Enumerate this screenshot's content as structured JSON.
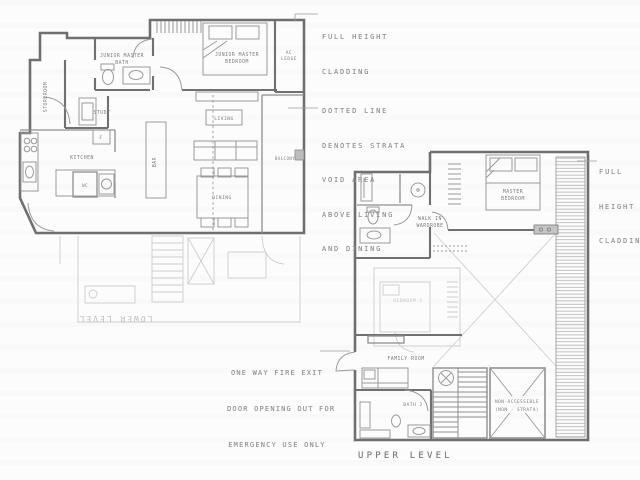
{
  "document": {
    "type": "architectural floor plan, scanned",
    "levels": [
      "LOWER LEVEL",
      "UPPER LEVEL"
    ]
  },
  "annotations": {
    "cladding_top": {
      "lines": [
        "FULL HEIGHT",
        "CLADDING"
      ]
    },
    "strata_note": {
      "lines": [
        "DOTTED LINE",
        "DENOTES STRATA",
        "VOID AREA",
        "ABOVE LIVING",
        "AND DINING"
      ]
    },
    "cladding_right": {
      "lines": [
        "FULL",
        "HEIGHT",
        "CLADDING"
      ]
    },
    "fire_exit_note": {
      "lines": [
        "ONE WAY FIRE EXIT",
        "DOOR OPENING OUT FOR",
        "EMERGENCY USE ONLY"
      ]
    },
    "upper_level_label": "UPPER LEVEL",
    "lower_level_ghost_label": "LOWER LEVEL"
  },
  "lower_plan": {
    "rooms": {
      "storeroom": "STOREROOM",
      "junior_master_bath": [
        "JUNIOR MASTER",
        "BATH"
      ],
      "junior_master_bedroom": [
        "JUNIOR MASTER",
        "BEDROOM"
      ],
      "ac_ledge": [
        "AC",
        "LEDGE"
      ],
      "study": "STUDY",
      "fridge": "F",
      "kitchen": "KITCHEN",
      "wc": "WC",
      "bar": "BAR",
      "living": "LIVING",
      "dining": "DINING",
      "balcony": "BALCONY"
    }
  },
  "upper_plan": {
    "rooms": {
      "walk_in_wardrobe": [
        "WALK IN",
        "WARDROBE"
      ],
      "master_bedroom": [
        "MASTER",
        "BEDROOM"
      ],
      "family_room": "FAMILY ROOM",
      "bath_2": "BATH 2",
      "non_accessible": [
        "NON-ACCESSIBLE",
        "(NON - STRATA)"
      ],
      "ghost_bedroom": "BEDROOM 2"
    }
  },
  "colors": {
    "paper": "#fcfcfc",
    "wall": "#6f6f6f",
    "thin_line": "#9a9a9a",
    "ghost_line": "#c9c9c9",
    "hatch": "#a8a8a8",
    "annotation_text": "#8e8e8e",
    "label_text": "#7d7d7d"
  }
}
